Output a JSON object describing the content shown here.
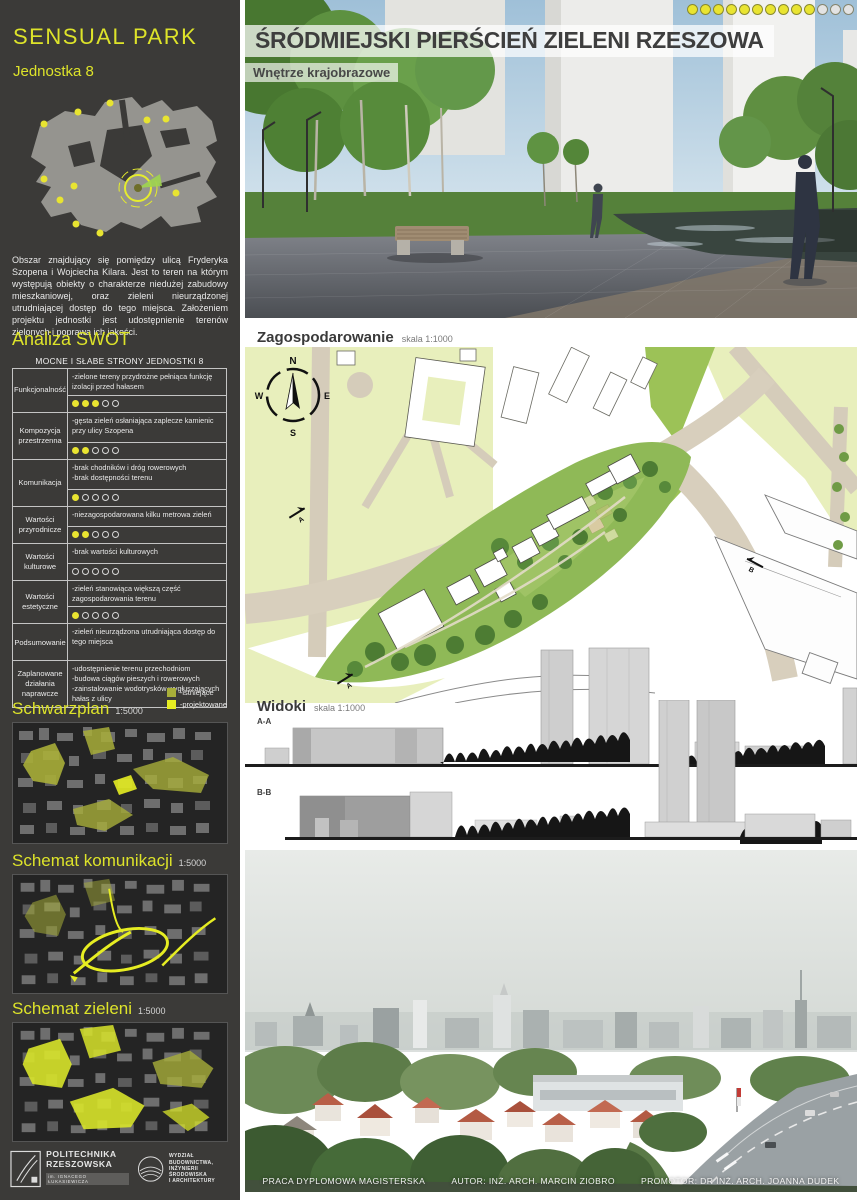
{
  "colors": {
    "sidebar_bg": "#3b3a38",
    "accent_yellow": "#dde32a",
    "rating_yellow": "#e9e431",
    "legend_existing": "#a8ae39",
    "legend_planned": "#e6ed22",
    "title_text": "#3e3e3e"
  },
  "sidebar": {
    "brand": "SENSUAL PARK",
    "unit": "Jednostka 8",
    "description": "Obszar znajdujący się pomiędzy ulicą  Fryderyka  Szopena i  Wojciecha  Kilara.  Jest  to  teren  na  którym  występują obiekty o charakterze niedużej  zabudowy mieszkaniowej, oraz zieleni nieurządzonej utrudniającej dostęp do tego miejsca. Założeniem projektu jednostki jest udostępnienie terenów zielonych i poprawa ich jakości.",
    "swot": {
      "heading": "Analiza SWOT",
      "table_title": "MOCNE I SŁABE STRONY JEDNOSTKI 8",
      "rows": [
        {
          "category": "Funkcjonalność",
          "description": "-zielone tereny przydrożne pełniąca funkcję izolacji przed hałasem",
          "rating": {
            "filled": 3,
            "total": 5
          }
        },
        {
          "category": "Kompozycja przestrzenna",
          "description": "-gęsta zieleń osłaniająca zaplecze kamienic przy ulicy Szopena",
          "rating": {
            "filled": 2,
            "total": 5
          }
        },
        {
          "category": "Komunikacja",
          "description": "-brak chodników i dróg rowerowych\n-brak dostępności terenu",
          "rating": {
            "filled": 1,
            "total": 5
          }
        },
        {
          "category": "Wartości przyrodnicze",
          "description": "-niezagospodarowana kilku metrowa zieleń",
          "rating": {
            "filled": 2,
            "total": 5
          }
        },
        {
          "category": "Wartości kulturowe",
          "description": "-brak wartości  kulturowych",
          "rating": {
            "filled": 0,
            "total": 5
          }
        },
        {
          "category": "Wartości estetyczne",
          "description": "-zieleń stanowiąca większą część zagospodarowania terenu",
          "rating": {
            "filled": 1,
            "total": 5
          }
        },
        {
          "category": "Podsumowanie",
          "description": "-zieleń nieurządzona utrudniająca dostęp do tego miejsca"
        },
        {
          "category": "Zaplanowane działania naprawcze",
          "description": "-udostępnienie terenu przechodniom\n-budowa ciągów pieszych i rowerowych\n-zainstalowanie wodotrysków wygłuszających hałas z ulicy"
        }
      ]
    },
    "legend": {
      "existing": "-istniejące",
      "planned": "-projektowane"
    },
    "schemas": [
      {
        "title": "Schwarzplan",
        "scale": "1:5000"
      },
      {
        "title": "Schemat komunikacji",
        "scale": "1:5000"
      },
      {
        "title": "Schemat zieleni",
        "scale": "1:5000"
      }
    ],
    "logos": {
      "university_line1": "POLITECHNIKA",
      "university_line2": "RZESZOWSKA",
      "university_sub": "im. IGNACEGO ŁUKASIEWICZA",
      "faculty_lines": [
        "WYDZIAŁ",
        "BUDOWNICTWA,",
        "INŻYNIERII ŚRODOWISKA",
        "I ARCHITEKTURY"
      ]
    }
  },
  "main": {
    "title": "ŚRÓDMIEJSKI PIERŚCIEŃ ZIELENI RZESZOWA",
    "subtitle": "Wnętrze krajobrazowe",
    "progress_dots": {
      "filled": 10,
      "total": 13
    },
    "plan": {
      "title": "Zagospodarowanie",
      "scale": "skala 1:1000",
      "marker_a": "A",
      "marker_b": "B"
    },
    "compass": {
      "n": "N",
      "e": "E",
      "s": "S",
      "w": "W"
    },
    "views": {
      "title": "Widoki",
      "scale": "skala 1:1000",
      "label_a": "A-A",
      "label_b": "B-B"
    },
    "footer": {
      "part1": "PRACA DYPLOMOWA MAGISTERSKA",
      "part2": "AUTOR: INŻ. ARCH. MARCIN ZIOBRO",
      "part3": "PROMOTOR: DR INŻ. ARCH. JOANNA DUDEK"
    }
  }
}
